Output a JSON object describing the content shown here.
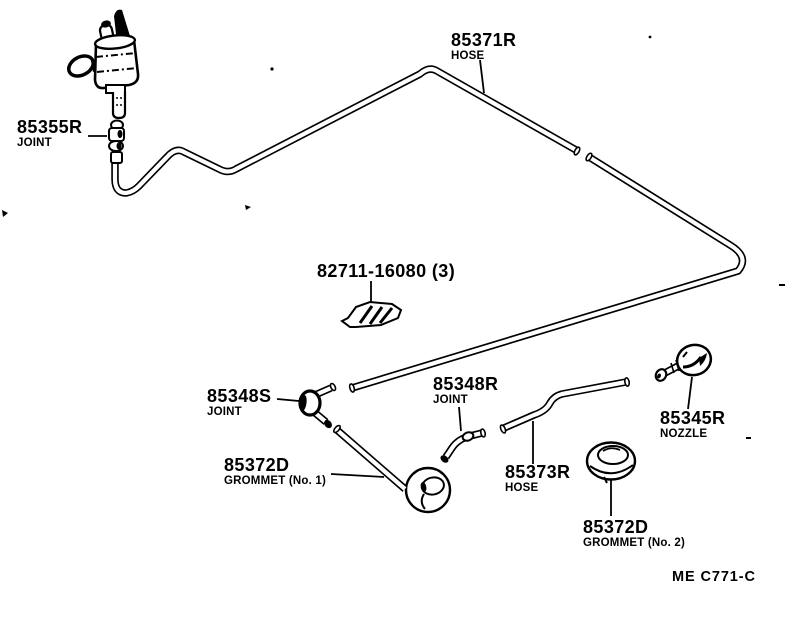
{
  "page": {
    "background_color": "#ffffff",
    "ink_color": "#000000"
  },
  "diagram": {
    "type": "exploded-parts-diagram",
    "drawing_code": "ME C771-C",
    "labels": {
      "hose_main": {
        "part_no": "85371R",
        "caption": "HOSE"
      },
      "joint_pump": {
        "part_no": "85355R",
        "caption": "JOINT"
      },
      "clip": {
        "part_no": "82711-16080 (3)",
        "caption": ""
      },
      "joint_s": {
        "part_no": "85348S",
        "caption": "JOINT"
      },
      "joint_r": {
        "part_no": "85348R",
        "caption": "JOINT"
      },
      "nozzle": {
        "part_no": "85345R",
        "caption": "NOZZLE"
      },
      "grommet_1": {
        "part_no": "85372D",
        "caption": "GROMMET (No. 1)"
      },
      "hose_rear": {
        "part_no": "85373R",
        "caption": "HOSE"
      },
      "grommet_2": {
        "part_no": "85372D",
        "caption": "GROMMET (No. 2)"
      }
    }
  }
}
